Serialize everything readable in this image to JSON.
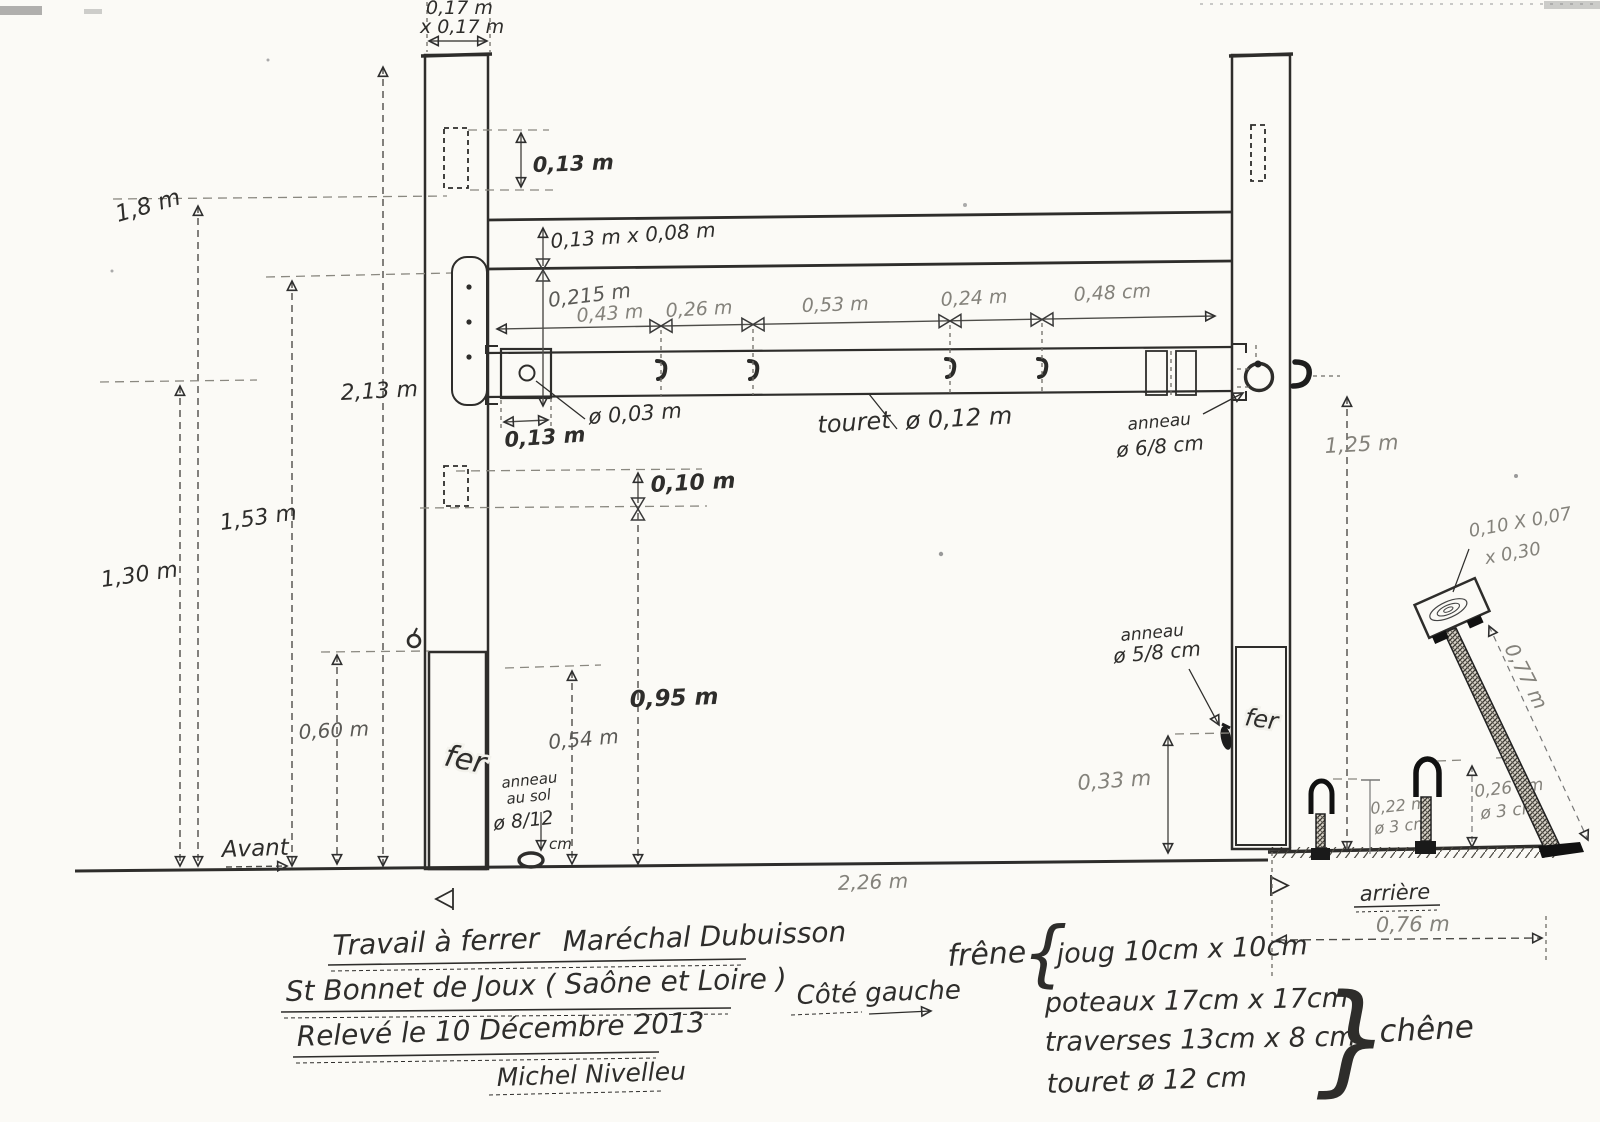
{
  "drawing": {
    "top": {
      "post_section_1": "0,17 m",
      "post_section_2": "x 0,17 m",
      "mortise_h": "0,13 m"
    },
    "traverse": {
      "section": "0,13 m x 0,08 m",
      "offset": "0,215 m"
    },
    "segments": [
      "0,43 m",
      "0,26 m",
      "0,53 m",
      "0,24 m",
      "0,48 cm"
    ],
    "touret": {
      "word": "touret",
      "dia": "ø 0,12 m",
      "axle_dia": "ø 0,03 m",
      "block_w": "0,13 m"
    },
    "heights": {
      "h1": "1,8 m",
      "h2": "2,13 m",
      "h3": "1,53 m",
      "h4": "1,30 m",
      "h5": "0,60 m",
      "h6": "0,54 m",
      "h7": "0,95 m",
      "h8": "0,10 m",
      "h9": "1,25 m",
      "h10": "0,33 m"
    },
    "rings": {
      "beam_1": "anneau",
      "beam_2": "ø 6/8 cm",
      "post_1": "anneau",
      "post_2": "ø 5/8 cm",
      "sol_1": "anneau",
      "sol_2": "au sol",
      "sol_3": "ø 8/12",
      "sol_4": "cm"
    },
    "fer_left": "fer",
    "fer_right": "fer",
    "right": {
      "block_1": "0,10 X 0,07",
      "block_2": "x 0,30",
      "slope": "0,77 m",
      "stake1_h": "0,22 m",
      "stake1_d": "ø 3 cm",
      "stake2_h": "0,26 cm",
      "stake2_d": "ø 3 cm",
      "rear_w": "0,76 m"
    },
    "ground": {
      "span": "2,26 m",
      "front": "Avant",
      "rear": "arrière"
    },
    "titleblock": {
      "line1a": "Travail à ferrer",
      "line1b": "Maréchal Dubuisson",
      "line2": "St Bonnet de Joux ( Saône et Loire )",
      "line3": "Relevé le 10 Décembre 2013",
      "signature": "Michel Nivelleu",
      "side": "Côté gauche"
    },
    "materials": {
      "wood_frame": "frêne",
      "brace_open": "{",
      "brace_close": "}",
      "joug": "joug 10cm x 10cm",
      "poteaux": "poteaux 17cm x 17cm",
      "traverses": "traverses 13cm x 8 cm",
      "touret": "touret ø 12 cm",
      "wood_posts": "chêne"
    }
  }
}
